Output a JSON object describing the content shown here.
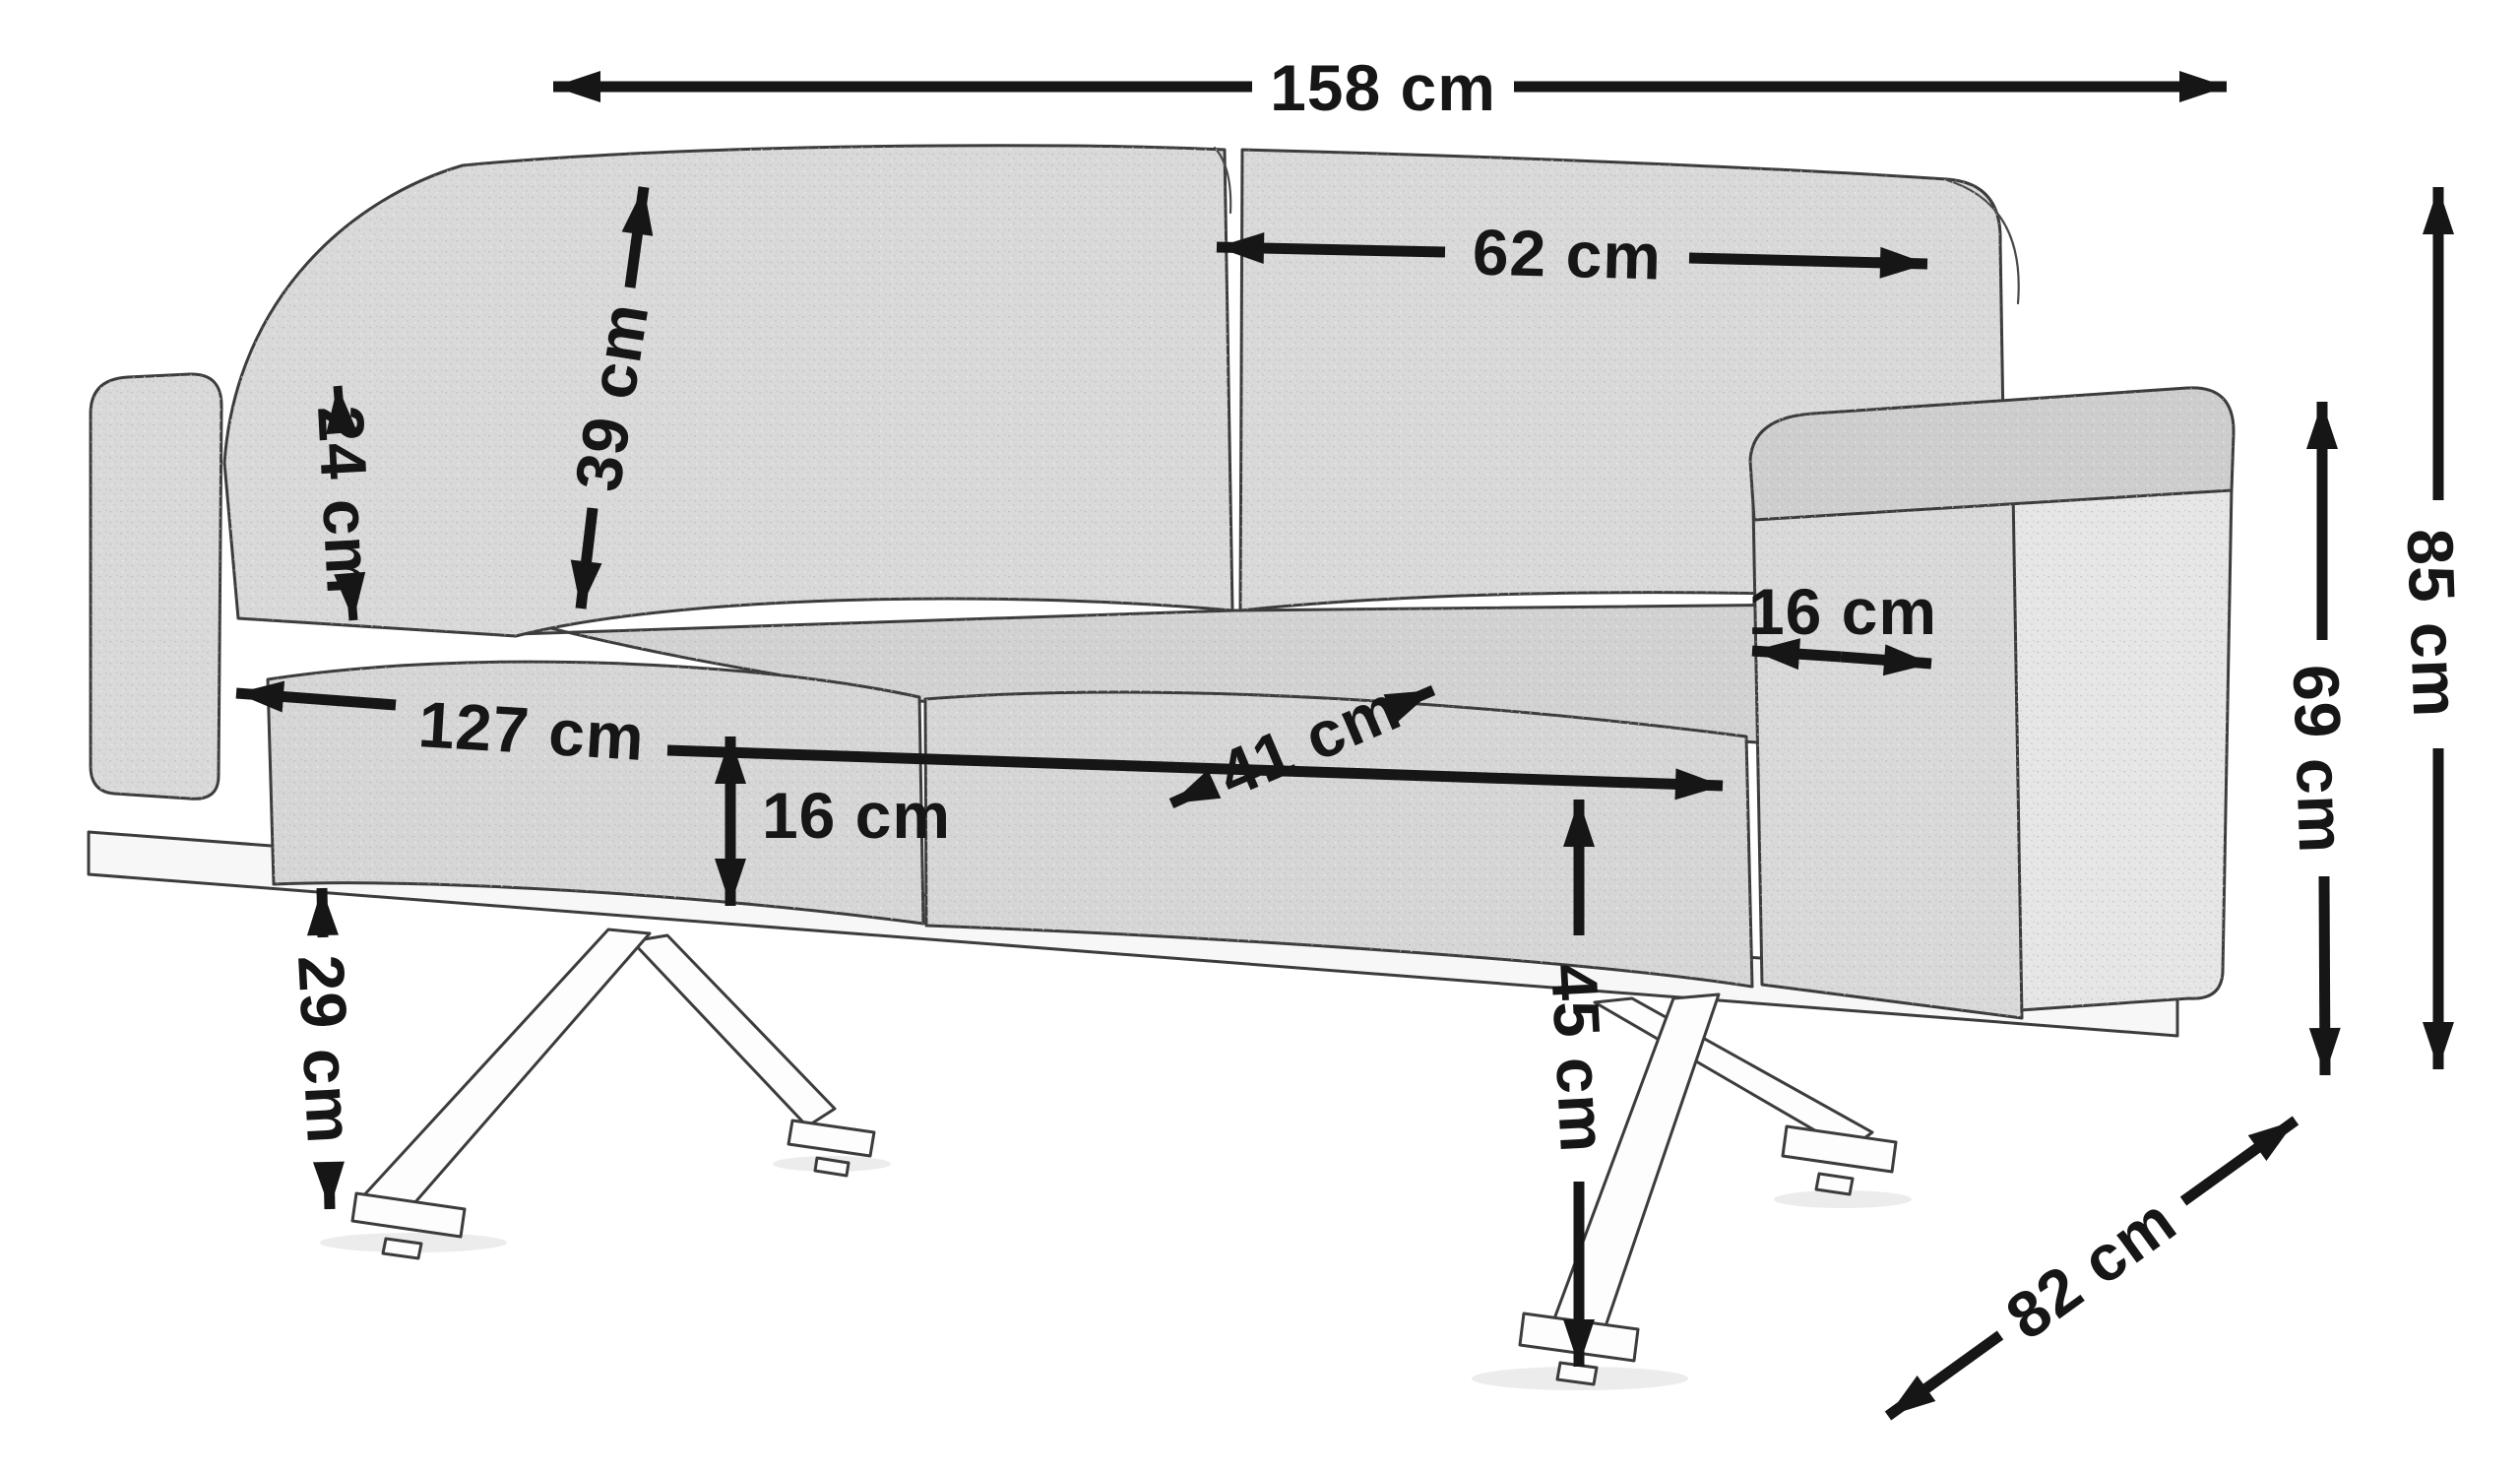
{
  "diagram": {
    "subject": "two-seat sofa on metal cross legs — dimension drawing",
    "unit": "cm",
    "colors": {
      "background": "#ffffff",
      "line": "#161616",
      "text": "#161616",
      "fabric": "#d9d9d9",
      "fabric_light": "#e6e6e6",
      "base_rail": "#f7f7f7"
    },
    "dimensions": {
      "overall_width": {
        "label": "158 cm",
        "value": 158
      },
      "back_cushion_width": {
        "label": "62 cm",
        "value": 62
      },
      "back_cushion_height": {
        "label": "39 cm",
        "value": 39
      },
      "armrest_top_depth": {
        "label": "24 cm",
        "value": 24
      },
      "armrest_width": {
        "label": "16 cm",
        "value": 16
      },
      "seat_width": {
        "label": "127 cm",
        "value": 127
      },
      "seat_depth": {
        "label": "41 cm",
        "value": 41
      },
      "seat_cushion_thickness": {
        "label": "16 cm",
        "value": 16
      },
      "seat_height": {
        "label": "45 cm",
        "value": 45
      },
      "underframe_clearance": {
        "label": "29 cm",
        "value": 29
      },
      "overall_height": {
        "label": "85 cm",
        "value": 85
      },
      "armrest_height": {
        "label": "69 cm",
        "value": 69
      },
      "overall_depth": {
        "label": "82 cm",
        "value": 82
      }
    }
  }
}
